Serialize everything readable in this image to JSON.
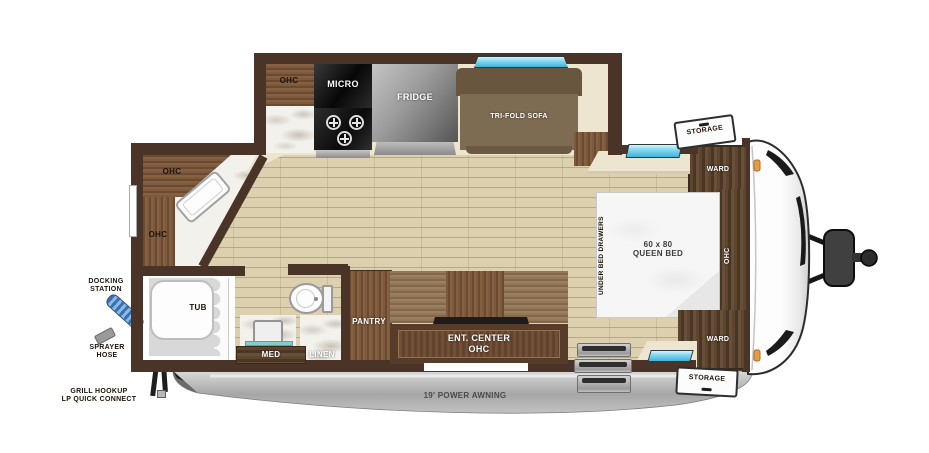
{
  "colors": {
    "wall": "#4a3428",
    "wood": "#77543a",
    "dark_wood": "#57402b",
    "floor": "#dcd0ae",
    "window_blue": "#56c2e4",
    "awning_gray": "#b5b5b5",
    "marker_light_orange": "#e29d42"
  },
  "slide_kitchen": {
    "ohc": "OHC",
    "micro": "MICRO",
    "fridge": "FRIDGE",
    "sofa": "TRI-FOLD SOFA"
  },
  "corner_kitchen": {
    "ohc_upper": "OHC",
    "ohc_lower": "OHC"
  },
  "bathroom": {
    "tub": "TUB",
    "med": "MED",
    "linen": "LINEN"
  },
  "hall": {
    "pantry": "PANTRY",
    "ent_center_line1": "ENT. CENTER",
    "ent_center_line2": "OHC"
  },
  "bedroom": {
    "ward_top": "WARD",
    "ward_bottom": "WARD",
    "ohc": "OHC",
    "bed_line1": "60 x 80",
    "bed_line2": "QUEEN BED",
    "under_bed": "UNDER BED DRAWERS",
    "storage_top": "STORAGE",
    "storage_bottom": "STORAGE"
  },
  "exterior": {
    "docking_line1": "DOCKING",
    "docking_line2": "STATION",
    "sprayer_line1": "SPRAYER",
    "sprayer_line2": "HOSE",
    "grill_line1": "GRILL HOOKUP",
    "grill_line2": "LP QUICK CONNECT",
    "awning": "19' POWER AWNING"
  }
}
